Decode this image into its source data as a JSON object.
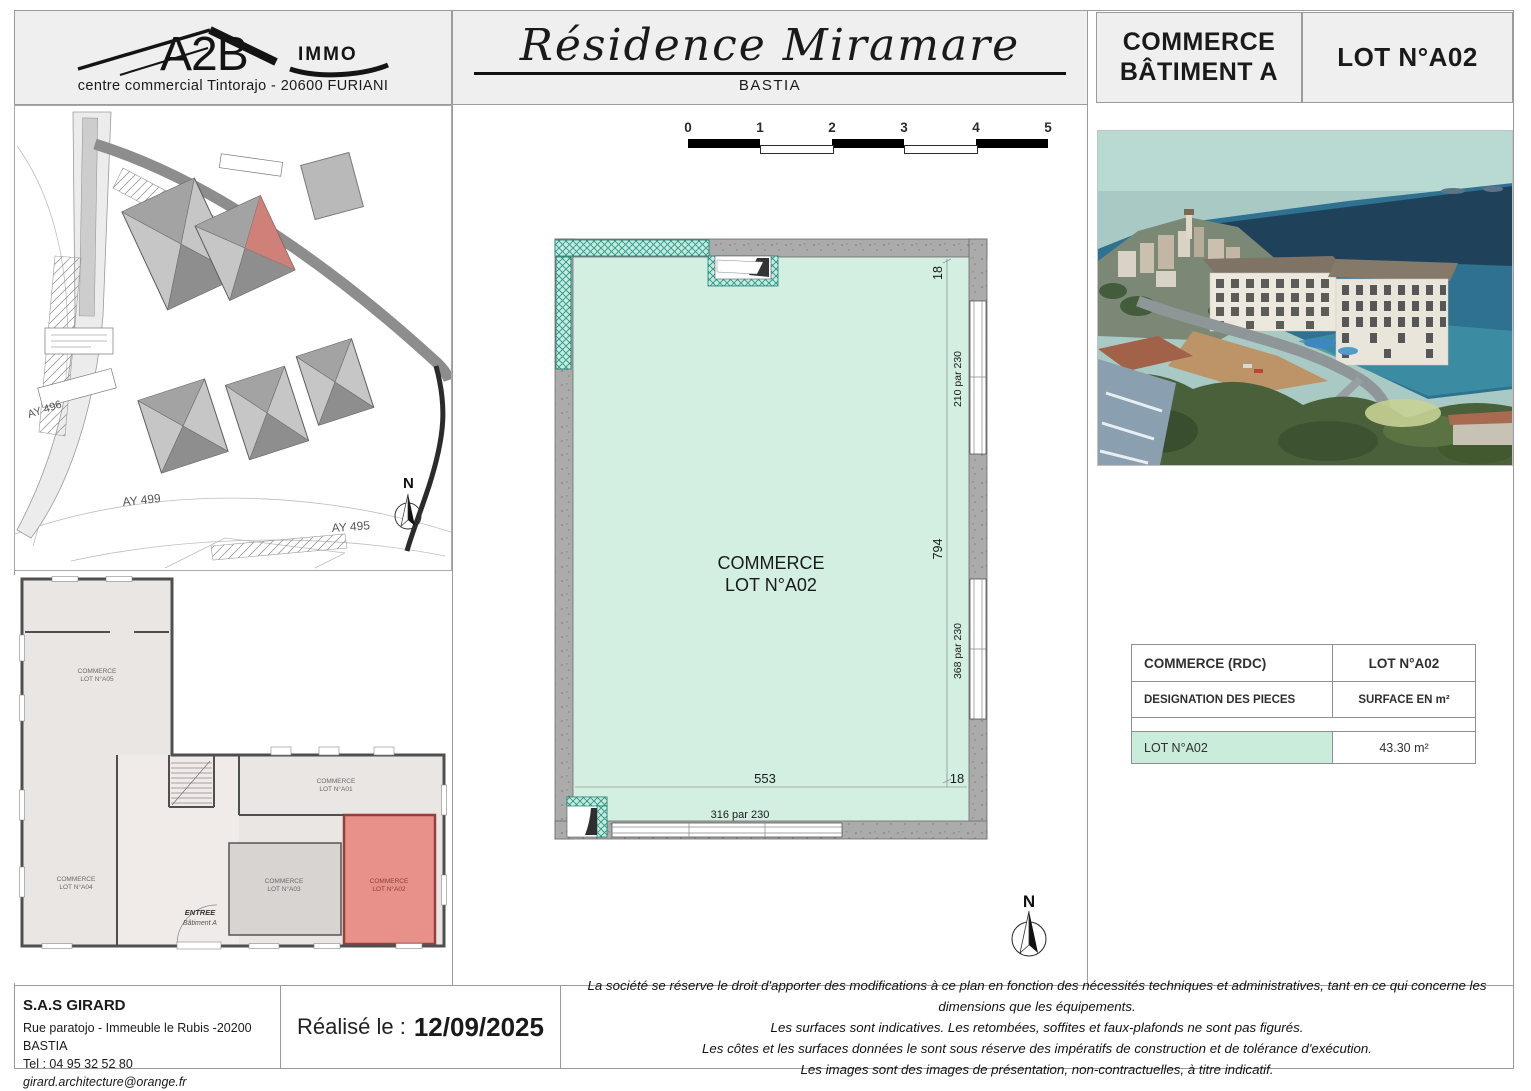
{
  "header": {
    "logo": {
      "brand": "A2B",
      "brand_suffix": "IMMO",
      "address": "centre commercial Tintorajo - 20600 FURIANI"
    },
    "title": "Résidence Miramare",
    "city": "BASTIA",
    "building_line1": "COMMERCE",
    "building_line2": "BÂTIMENT A",
    "lot": "LOT N°A02"
  },
  "scale_bar": {
    "ticks": [
      "0",
      "1",
      "2",
      "3",
      "4",
      "5"
    ]
  },
  "site_plan": {
    "parcel_labels": [
      "AY 496",
      "AY 499",
      "AY 495"
    ],
    "north": "N"
  },
  "overview_plan": {
    "lots": [
      {
        "line1": "COMMERCE",
        "line2": "LOT N°A05"
      },
      {
        "line1": "COMMERCE",
        "line2": "LOT N°A04"
      },
      {
        "line1": "COMMERCE",
        "line2": "LOT N°A01"
      },
      {
        "line1": "COMMERCE",
        "line2": "LOT N°A03"
      },
      {
        "line1": "COMMERCE",
        "line2": "LOT N°A02"
      }
    ],
    "entrance_line1": "ENTREE",
    "entrance_line2": "Bâtiment A"
  },
  "main_plan": {
    "room_line1": "COMMERCE",
    "room_line2": "LOT N°A02",
    "dim_top_right": "18",
    "dim_right_height": "794",
    "dim_bottom_width": "553",
    "dim_bottom_right": "18",
    "window_right_top": "210 par 230",
    "window_right_bottom": "368 par 230",
    "window_bottom": "316 par 230",
    "north": "N"
  },
  "surface_table": {
    "title_left": "COMMERCE (RDC)",
    "title_right": "LOT N°A02",
    "col_left": "DESIGNATION DES PIECES",
    "col_right": "SURFACE EN m²",
    "rows": [
      {
        "designation": "LOT N°A02",
        "surface": "43.30 m²"
      }
    ]
  },
  "footer": {
    "company": "S.A.S GIRARD",
    "address": "Rue paratojo - Immeuble le Rubis -20200 BASTIA",
    "phone": "Tel :  04 95 32 52 80",
    "email": "girard.architecture@orange.fr",
    "date_label": "Réalisé le :",
    "date_value": "12/09/2025",
    "disclaimer": [
      "La société se réserve le droit d'apporter des modifications à ce plan en fonction des nécessités techniques et administratives, tant en ce qui concerne les dimensions que les équipements.",
      "Les surfaces sont indicatives. Les retombées, soffites et faux-plafonds ne sont pas figurés.",
      "Les côtes et les surfaces données le sont sous réserve des impératifs de construction et de tolérance d'exécution.",
      "Les images sont des images de présentation, non-contractuelles, à titre indicatif."
    ]
  },
  "colors": {
    "mint_floor": "#d3efe2",
    "teal_hatch": "#2a9688",
    "wall_gray": "#a9a9a9",
    "highlight_red": "#e8918a",
    "table_mint": "#c9ecdb",
    "panel_bg": "#efefef"
  }
}
